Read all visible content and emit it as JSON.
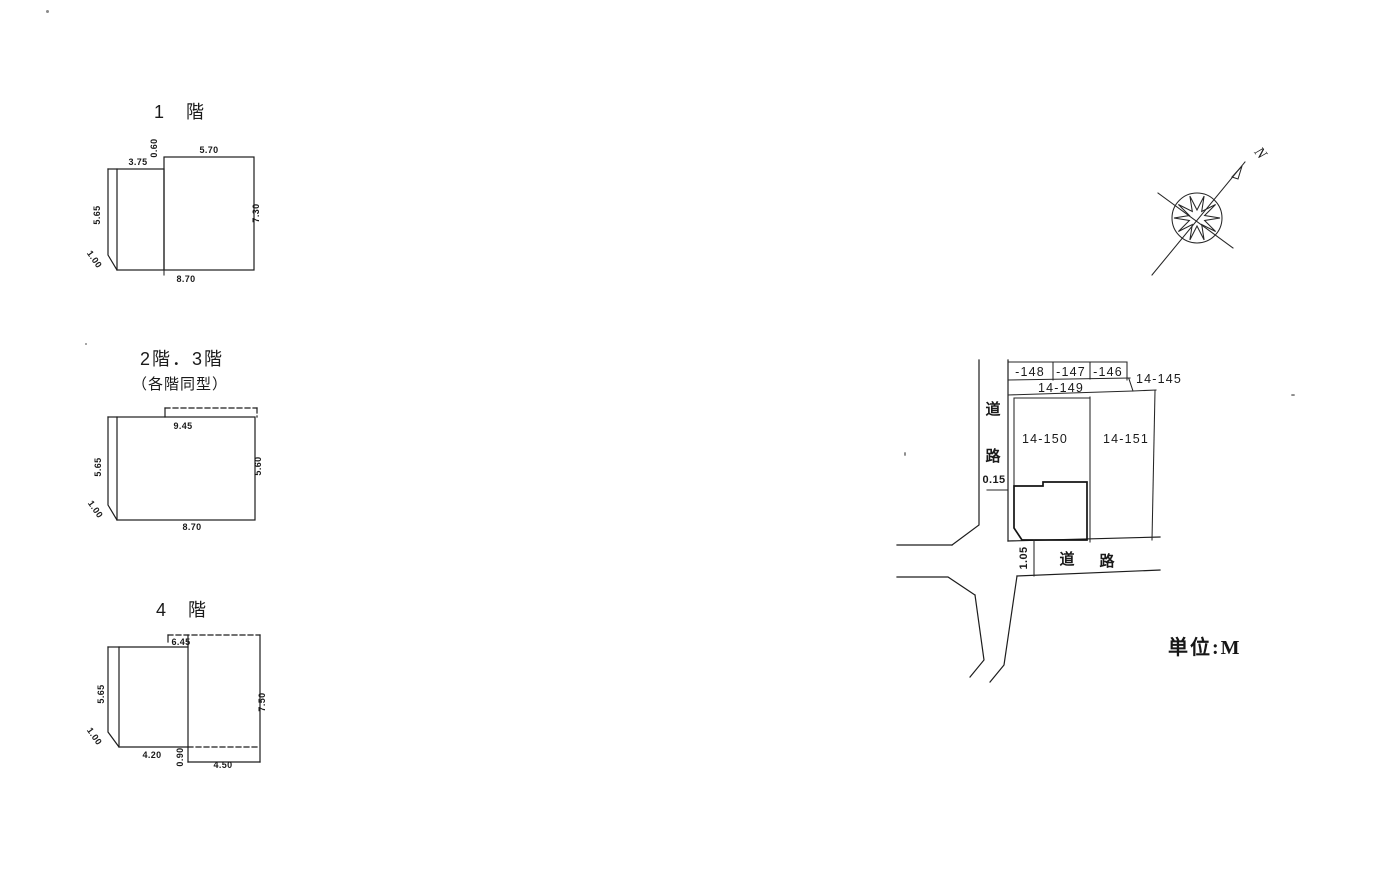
{
  "scan": {
    "north_label": "N",
    "unit_label": "単位:M"
  },
  "floor1": {
    "title": "1　階",
    "dims": {
      "top_left": "3.75",
      "step": "0.60",
      "top_right": "5.70",
      "left": "5.65",
      "right": "7.30",
      "chamfer": "1.00",
      "bottom": "8.70"
    }
  },
  "floor23": {
    "title": "2階．3階",
    "subtitle": "（各階同型）",
    "dims": {
      "top": "9.45",
      "left": "5.65",
      "right": "5.60",
      "chamfer": "1.00",
      "bottom": "8.70"
    }
  },
  "floor4": {
    "title": "4　階",
    "dims": {
      "top": "6.45",
      "left": "5.65",
      "right": "7.50",
      "chamfer": "1.00",
      "bottom_left": "4.20",
      "step": "0.90",
      "bottom_right": "4.50"
    }
  },
  "site": {
    "lots": {
      "l148": "-148",
      "l147": "-147",
      "l146": "-146",
      "l145": "14-145",
      "l149": "14-149",
      "l150": "14-150",
      "l151": "14-151"
    },
    "road_vertical": {
      "char1": "道",
      "char2": "路"
    },
    "road_horizontal": {
      "char1": "道",
      "char2": "路"
    },
    "dims": {
      "road_offset": "0.15",
      "setback": "1.05"
    }
  }
}
